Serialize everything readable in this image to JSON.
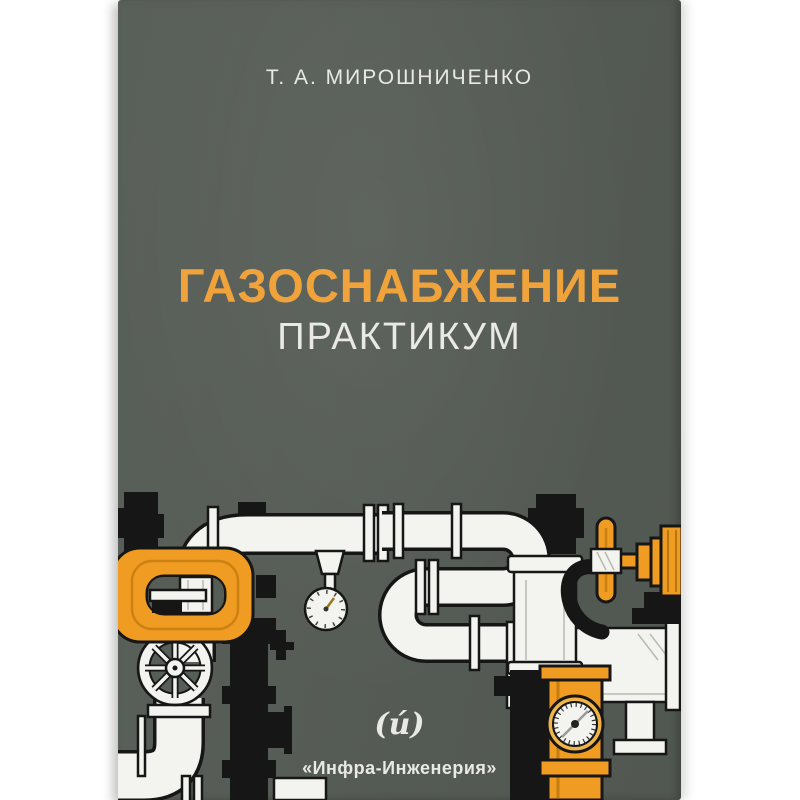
{
  "book": {
    "author": "Т. А. МИРОШНИЧЕНКО",
    "title": "ГАЗОСНАБЖЕНИЕ",
    "subtitle": "ПРАКТИКУМ",
    "publisher_logo": "(и́)",
    "publisher": "«Инфра-Инженерия»",
    "illustration_alt": "Line-art gas pipeline with valves, flanges, handwheels and pressure gauges",
    "colors": {
      "cover": "#565c56",
      "title": "#f1a33b",
      "text": "#e9e9e5",
      "orange": "#f09b22",
      "ink": "#161616",
      "pipe": "#f3f3ef"
    }
  }
}
